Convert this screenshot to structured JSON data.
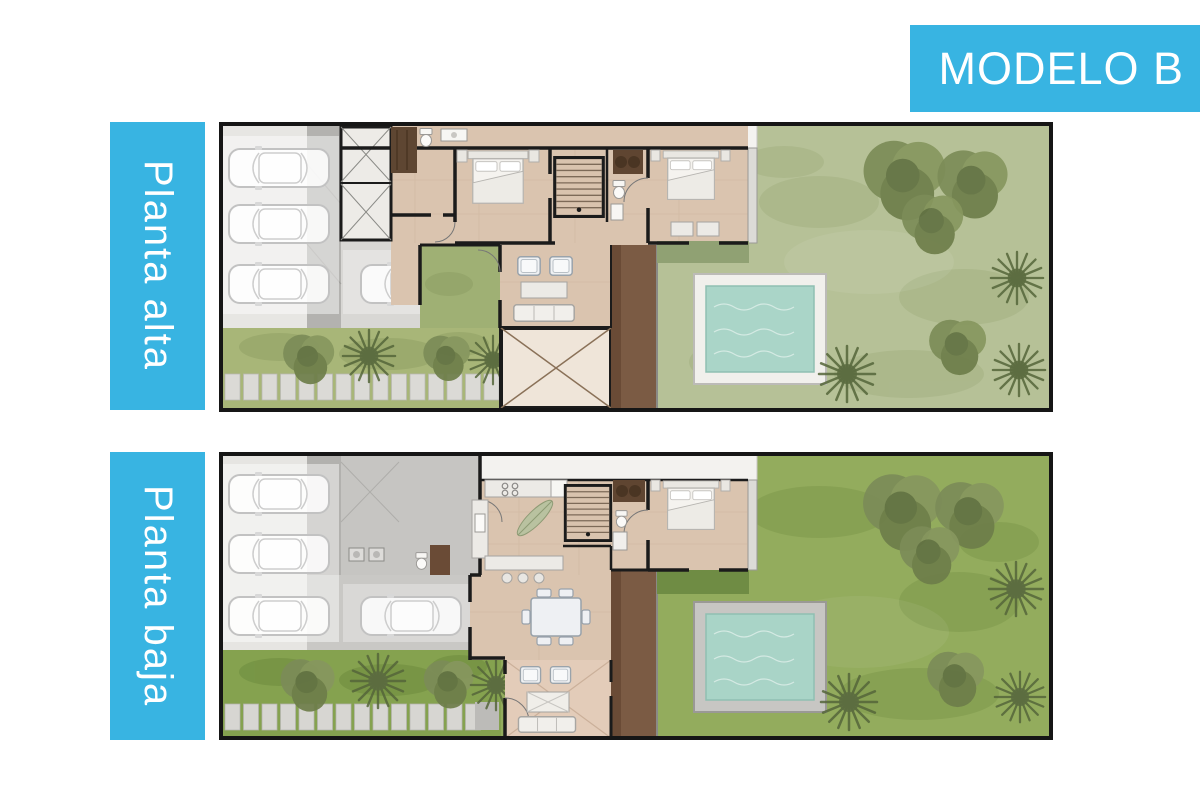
{
  "banner": {
    "title": "MODELO B"
  },
  "plans": [
    {
      "id": "planta-alta",
      "label": "Planta alta"
    },
    {
      "id": "planta-baja",
      "label": "Planta baja"
    }
  ],
  "palette": {
    "accent": "#38b4e2",
    "label_text": "#ffffff",
    "plan_border": "#161616",
    "floor_tan": "#dac4af",
    "wood_deck": "#7b5b44",
    "garden_pale": "#b6c197",
    "garden_vivid": "#93ac5d",
    "hedge_pale": "#a8b678",
    "hedge_vivid": "#85a24f",
    "pool_water": "#aad5c8",
    "pool_deck_alta": "#f1f0ec",
    "pool_deck_baja": "#c7c6c3",
    "parking_gray": "#d8d7d4"
  }
}
